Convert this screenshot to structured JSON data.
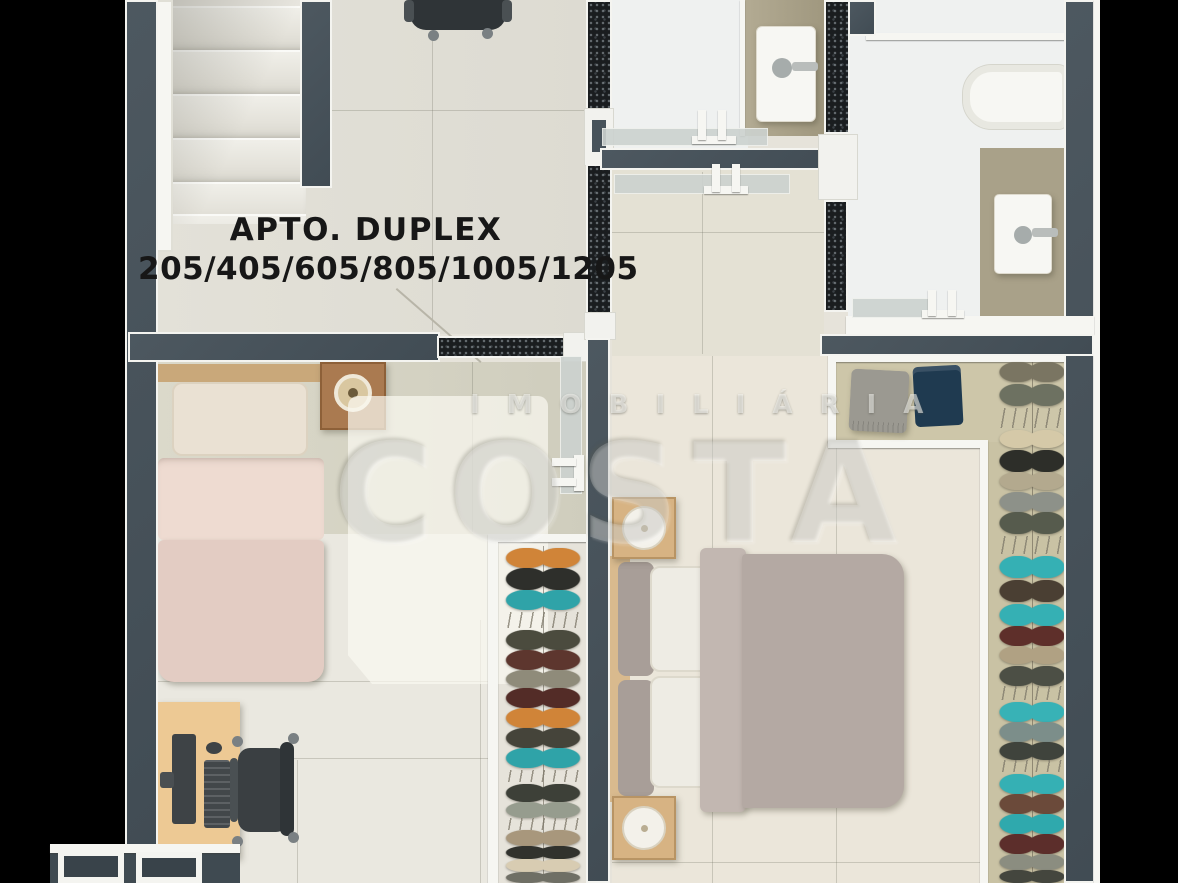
{
  "title": {
    "line1": "APTO. DUPLEX",
    "line2": "205/405/605/805/1005/1205"
  },
  "watermark": {
    "brand_top": "IMOBILIÁRIA",
    "brand_main": "COSTA"
  },
  "palette": {
    "background": "#000000",
    "wall": "#47525a",
    "wall_cut": "#1a1d1f",
    "frame_white": "#f2f2ee",
    "floor": "#e6e3da",
    "floor_dim": "#d7d5c6",
    "bath_counter": "#a9a189",
    "closet_interior": "#bdb9a4",
    "bed1_duvet": "#e2cbc2",
    "bed2_duvet": "#b4a9a3",
    "wood": "#d6b285",
    "desk": "#ecc994",
    "device_gray": "#3e4346",
    "lamp_white": "#f3f1ea",
    "accent_teal": "#2fa9ad",
    "accent_orange": "#d08438",
    "shorts_navy": "#1f3a50",
    "folded_cloth_gray": "#9b9991"
  },
  "objects": [
    "staircase",
    "office-chair",
    "toilet",
    "toilet",
    "bathtub",
    "single-bed",
    "nightstand-with-lamp",
    "rug",
    "desk-with-computer",
    "office-chair",
    "double-bed",
    "nightstand-with-lamp",
    "nightstand-with-lamp",
    "wardrobe-shelf",
    "clothes-rail",
    "clothes-rail",
    "windows",
    "glass-doors"
  ],
  "stairs": {
    "step_ys": [
      6,
      50,
      94,
      138,
      182,
      214
    ]
  },
  "closet_mid": {
    "rod_x": 547,
    "items": [
      {
        "y": 548,
        "h": 20,
        "c": "#d08438",
        "t": "garment"
      },
      {
        "y": 568,
        "h": 22,
        "c": "#2e2f2b",
        "t": "garment"
      },
      {
        "y": 590,
        "h": 20,
        "c": "#2fa3a8",
        "t": "garment"
      },
      {
        "y": 612,
        "h": 16,
        "c": "",
        "t": "hangers"
      },
      {
        "y": 630,
        "h": 20,
        "c": "#4b4b3e",
        "t": "garment"
      },
      {
        "y": 650,
        "h": 20,
        "c": "#5d362e",
        "t": "garment"
      },
      {
        "y": 670,
        "h": 18,
        "c": "#8f8b7a",
        "t": "garment"
      },
      {
        "y": 688,
        "h": 20,
        "c": "#532c27",
        "t": "garment"
      },
      {
        "y": 708,
        "h": 20,
        "c": "#d08438",
        "t": "garment"
      },
      {
        "y": 728,
        "h": 20,
        "c": "#45443a",
        "t": "garment"
      },
      {
        "y": 748,
        "h": 20,
        "c": "#2fa3a8",
        "t": "garment"
      },
      {
        "y": 770,
        "h": 12,
        "c": "",
        "t": "hangers"
      },
      {
        "y": 784,
        "h": 18,
        "c": "#3d4038",
        "t": "garment"
      },
      {
        "y": 802,
        "h": 16,
        "c": "#969c8e",
        "t": "garment"
      },
      {
        "y": 818,
        "h": 12,
        "c": "",
        "t": "hangers"
      },
      {
        "y": 830,
        "h": 16,
        "c": "#a8977c",
        "t": "garment"
      },
      {
        "y": 846,
        "h": 13,
        "c": "#31322d",
        "t": "garment"
      },
      {
        "y": 859,
        "h": 13,
        "c": "#d8ccb2",
        "t": "garment"
      },
      {
        "y": 872,
        "h": 11,
        "c": "#6f6f65",
        "t": "garment"
      }
    ]
  },
  "closet_right": {
    "rod_x": 1036,
    "items": [
      {
        "y": 362,
        "h": 20,
        "c": "#7a7562",
        "t": "garment"
      },
      {
        "y": 384,
        "h": 22,
        "c": "#6d7161",
        "t": "garment"
      },
      {
        "y": 408,
        "h": 20,
        "c": "",
        "t": "hangers"
      },
      {
        "y": 430,
        "h": 18,
        "c": "#d5c9a8",
        "t": "garment"
      },
      {
        "y": 450,
        "h": 22,
        "c": "#2d2e29",
        "t": "garment"
      },
      {
        "y": 472,
        "h": 18,
        "c": "#b3a98e",
        "t": "garment"
      },
      {
        "y": 492,
        "h": 20,
        "c": "#8d9189",
        "t": "garment"
      },
      {
        "y": 512,
        "h": 22,
        "c": "#565b4d",
        "t": "garment"
      },
      {
        "y": 536,
        "h": 18,
        "c": "",
        "t": "hangers"
      },
      {
        "y": 556,
        "h": 22,
        "c": "#35b0b4",
        "t": "garment"
      },
      {
        "y": 580,
        "h": 22,
        "c": "#4a3f33",
        "t": "garment"
      },
      {
        "y": 604,
        "h": 22,
        "c": "#35b0b4",
        "t": "garment"
      },
      {
        "y": 626,
        "h": 20,
        "c": "#5e2f2a",
        "t": "garment"
      },
      {
        "y": 646,
        "h": 18,
        "c": "#b0a183",
        "t": "garment"
      },
      {
        "y": 666,
        "h": 20,
        "c": "#4c4f45",
        "t": "garment"
      },
      {
        "y": 686,
        "h": 14,
        "c": "",
        "t": "hangers"
      },
      {
        "y": 702,
        "h": 20,
        "c": "#38b2b6",
        "t": "garment"
      },
      {
        "y": 722,
        "h": 20,
        "c": "#7c8e8a",
        "t": "garment"
      },
      {
        "y": 742,
        "h": 18,
        "c": "#3f433c",
        "t": "garment"
      },
      {
        "y": 760,
        "h": 12,
        "c": "",
        "t": "hangers"
      },
      {
        "y": 774,
        "h": 20,
        "c": "#35b0b4",
        "t": "garment"
      },
      {
        "y": 794,
        "h": 20,
        "c": "#6b4a3a",
        "t": "garment"
      },
      {
        "y": 814,
        "h": 20,
        "c": "#2fa9ad",
        "t": "garment"
      },
      {
        "y": 834,
        "h": 20,
        "c": "#5c2e2b",
        "t": "garment"
      },
      {
        "y": 854,
        "h": 16,
        "c": "#8b8d80",
        "t": "garment"
      },
      {
        "y": 870,
        "h": 13,
        "c": "#44463e",
        "t": "garment"
      }
    ]
  }
}
